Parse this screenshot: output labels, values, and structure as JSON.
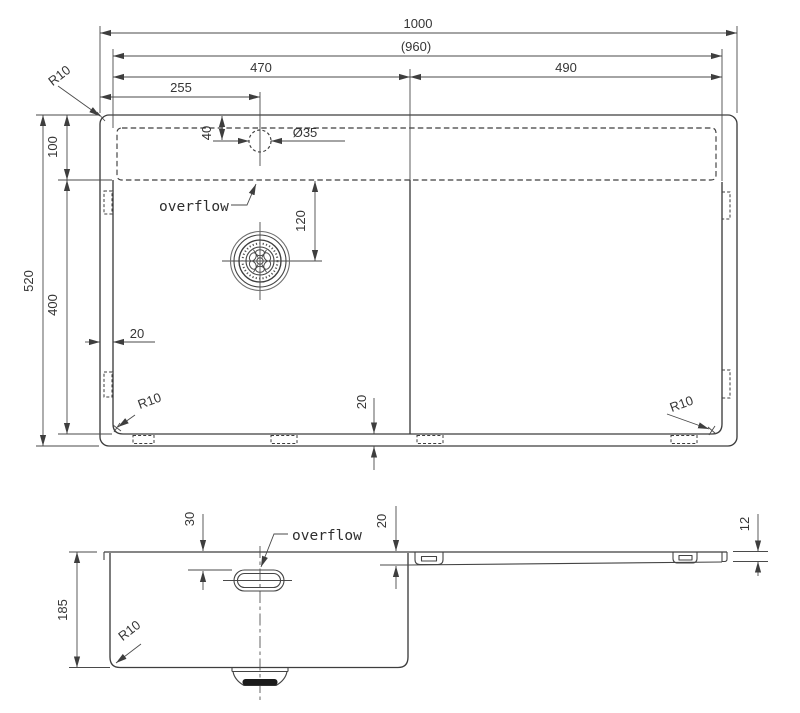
{
  "colors": {
    "line": "#3e3e3e",
    "text": "#353535",
    "dark_fill": "#1b1b1b",
    "background": "#ffffff"
  },
  "top_view": {
    "dimensions": {
      "overall_width": "1000",
      "inner_width": "(960)",
      "bowl_width": "470",
      "drainboard_width": "490",
      "faucet_x": "255",
      "faucet_y": "40",
      "faucet_diameter": "Ø35",
      "deck_depth": "100",
      "overall_depth": "520",
      "bowl_length": "400",
      "side_offset": "20",
      "bottom_offset": "20",
      "drain_from_deck": "120",
      "r_top_left": "R10",
      "r_bottom_left": "R10",
      "r_bottom_right": "R10"
    },
    "labels": {
      "overflow": "overflow"
    }
  },
  "section_view": {
    "dimensions": {
      "overflow_depth": "30",
      "board_depth_inner": "20",
      "board_depth_outer": "12",
      "bowl_depth": "185",
      "corner_radius": "R10"
    },
    "labels": {
      "overflow": "overflow"
    }
  }
}
